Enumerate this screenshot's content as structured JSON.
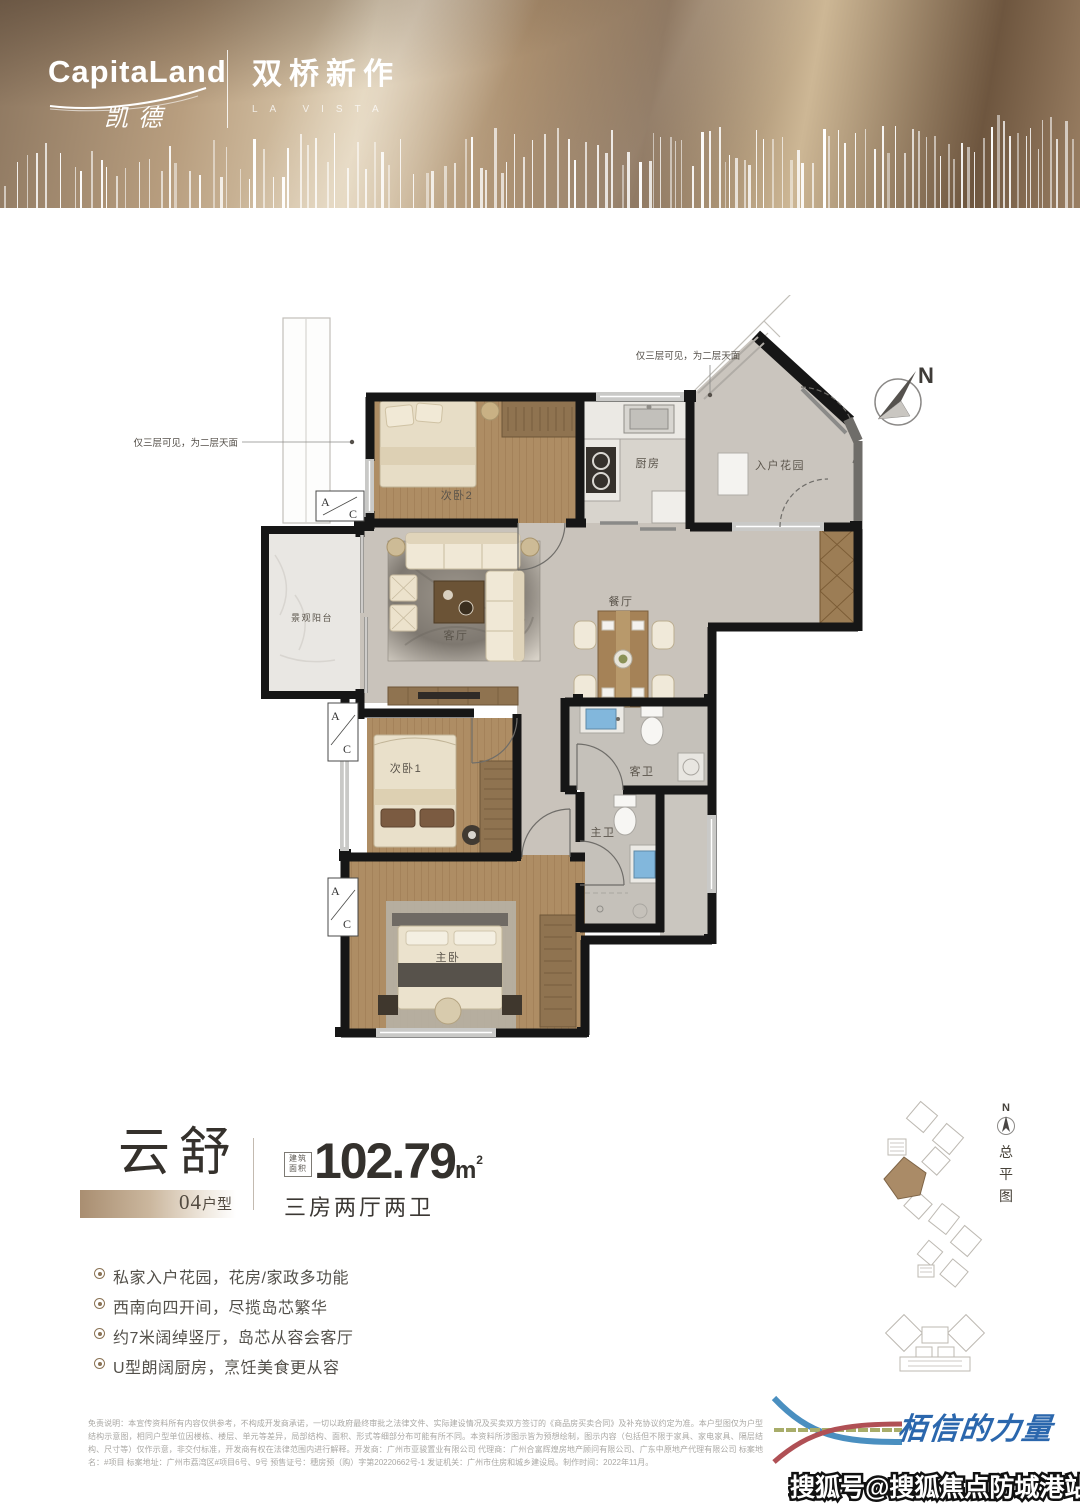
{
  "header": {
    "brand_en": "CapitaLand",
    "brand_cn": "凯德",
    "project_name": "双桥新作",
    "project_latin": "LA VISTA"
  },
  "floorplan": {
    "north": "N",
    "note_left": "仅三层可见，为二层天面",
    "note_top": "仅三层可见，为二层天面",
    "ac": {
      "a": "A",
      "c": "C"
    },
    "rooms": {
      "bedroom2": "次卧2",
      "kitchen": "厨房",
      "entry_garden": "入户花园",
      "balcony": "景观阳台",
      "living": "客厅",
      "dining": "餐厅",
      "bedroom1": "次卧1",
      "guest_bath": "客卫",
      "master_bath": "主卫",
      "master_bedroom": "主卧"
    }
  },
  "unit": {
    "name": "云舒",
    "type_number": "04",
    "type_label": "户型",
    "area_badge": [
      "建筑",
      "面积"
    ],
    "area_value": "102.79",
    "area_unit": "m",
    "area_sup": "2",
    "rooms_desc": "三房两厅两卫"
  },
  "features": [
    "私家入户花园，花房/家政多功能",
    "西南向四开间，尽揽岛芯繁华",
    "约7米阔绰竖厅，岛芯从容会客厅",
    "U型朗阔厨房，烹饪美食更从容"
  ],
  "siteplan": {
    "north": "N",
    "label": [
      "总",
      "平",
      "图"
    ]
  },
  "disclaimer": "免责说明：本宣传资料所有内容仅供参考，不构成开发商承诺，一切以政府最终审批之法律文件、实际建设情况及买卖双方签订的《商品房买卖合同》及补充协议约定为准。本户型图仅为户型结构示意图，相同户型单位因楼栋、楼层、单元等差异，局部结构、面积、形式等细部分布可能有所不同。本资料所涉图示皆为预想绘制，图示内容（包括但不限于家具、家电家具、隔层结构、尺寸等）仅作示意，非交付标准，开发商有权在法律范围内进行解释。开发商：广州市亚骏置业有限公司 代理商：广州合富辉煌房地产顾问有限公司、广东中原地产代理有限公司 标案地名：#项目 标案地址：广州市荔湾区#项目6号、9号 预售证号：穗房预（购）字第20220662号-1 发证机关：广州市住房和城乡建设局。制作时间：2022年11月。",
  "footer": {
    "slogan": "栢信的力量",
    "watermark": "搜狐号@搜狐焦点防城港站"
  }
}
